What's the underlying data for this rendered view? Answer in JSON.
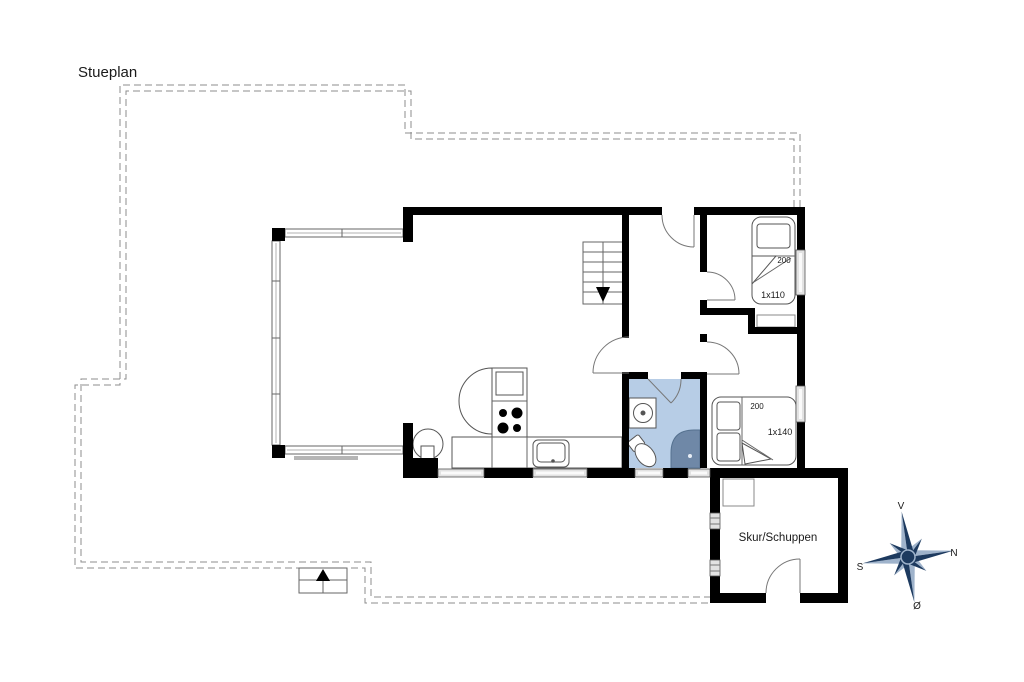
{
  "title": "Stueplan",
  "plan": {
    "shed_label": "Skur/Schuppen",
    "bed_single": {
      "length": "200",
      "size": "1x110"
    },
    "bed_double": {
      "length": "200",
      "size": "1x140"
    }
  },
  "compass": {
    "top": "V",
    "right": "N",
    "left": "S",
    "bottom": "Ø"
  },
  "colors": {
    "wall": "#000000",
    "bathroom_floor": "#b7cde6",
    "shower": "#6f88a7",
    "compass_dark": "#1d3a5f",
    "compass_light": "#9fb3cb",
    "dashed_line": "#8c8c8c",
    "window_fill": "#e2e2e2"
  }
}
